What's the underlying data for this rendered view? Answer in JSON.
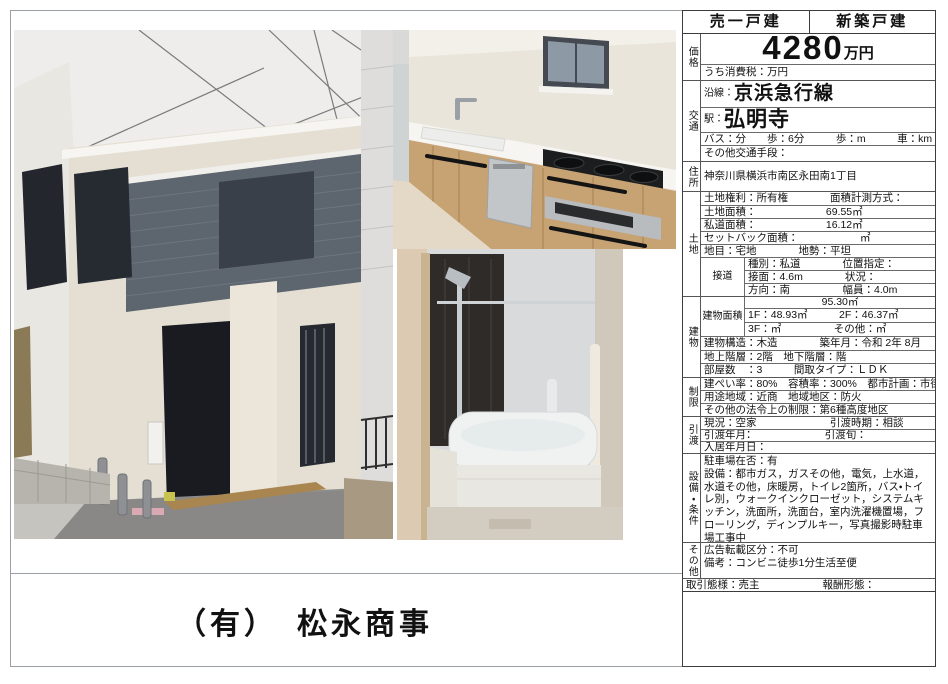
{
  "tabs": {
    "sale": "売一戸建",
    "new_build": "新築戸建"
  },
  "sections": {
    "price": {
      "label": "価格",
      "amount": "4280",
      "unit": "万円",
      "tax": "うち消費税：万円"
    },
    "transport": {
      "label": "交通",
      "line_k": "沿線：",
      "line_v": "京浜急行線",
      "sta_k": "駅：",
      "sta_v": "弘明寺",
      "bus": "バス：分　　歩：6分　　　歩：m　　　車：km",
      "other": "その他交通手段："
    },
    "address": {
      "label": "住所",
      "value": "神奈川県横浜市南区永田南1丁目"
    },
    "land": {
      "label": "土地",
      "rights": "土地権利：所有権　　　　面積計測方式：",
      "area_k": "土地面積：",
      "area_v": "69.55㎡",
      "private_k": "私道面積：",
      "private_v": "16.12㎡",
      "setback_k": "セットバック面積：",
      "setback_v": "㎡",
      "chimoku": "地目：宅地　　　　地勢：平坦",
      "road_label": "接道",
      "road1": "種別：私道　　　　位置指定：",
      "road2": "接面：4.6m　　　　状況：",
      "road3": "方向：南　　　　　幅員：4.0m"
    },
    "building": {
      "label": "建物",
      "area_label": "建物面積",
      "total": "95.30㎡",
      "f12": "1F：48.93㎡　　　2F：46.37㎡",
      "f3": "3F：㎡　　　　　その他：㎡",
      "structure": "建物構造：木造　　　　築年月：令和 2年 8月",
      "floors": "地上階層：2階　地下階層：階",
      "rooms": "部屋数　：3　　　間取タイプ：ＬＤＫ"
    },
    "restrictions": {
      "label": "制限",
      "kenpei": "建ぺい率：80%　容積率：300%　都市計画：市街",
      "youto": "用途地域：近商　地域地区：防火",
      "other_law": "その他の法令上の制限：第6種高度地区"
    },
    "handover": {
      "label": "引渡",
      "current": "現況：空家　　　　　　　引渡時期：相談",
      "ym": "引渡年月：　　　　　　　引渡旬：",
      "move_in": "入居年月日："
    },
    "equipment": {
      "label": "設備・条件",
      "parking": "駐車場在否：有",
      "items": "設備：都市ガス，ガスその他，電気，上水道，水道その他，床暖房，トイレ2箇所，バス・トイレ別，ウォークインクローゼット，システムキッチン，洗面所，洗面台，室内洗濯機置場，フローリング，ディンプルキー，写真撮影時駐車場工事中",
      "condition": "条件：2駅利用可能（京急井土ヶ谷駅徒歩8分）"
    },
    "other": {
      "label": "その他",
      "ad": "広告転載区分：不可",
      "note": "備考：コンビニ徒歩1分生活至便"
    },
    "deal": {
      "row": "取引態様：売主　　　　　　報酬形態："
    }
  },
  "company": {
    "name": "（有）　松永商事"
  },
  "photos": {
    "exterior_alt": "外観写真",
    "kitchen_alt": "キッチン写真",
    "bathroom_alt": "浴室写真"
  },
  "colors": {
    "table_border": "#3c3c3c",
    "sheet_border": "#9aa0a6",
    "accent_dark_wall": "#5d656f"
  }
}
